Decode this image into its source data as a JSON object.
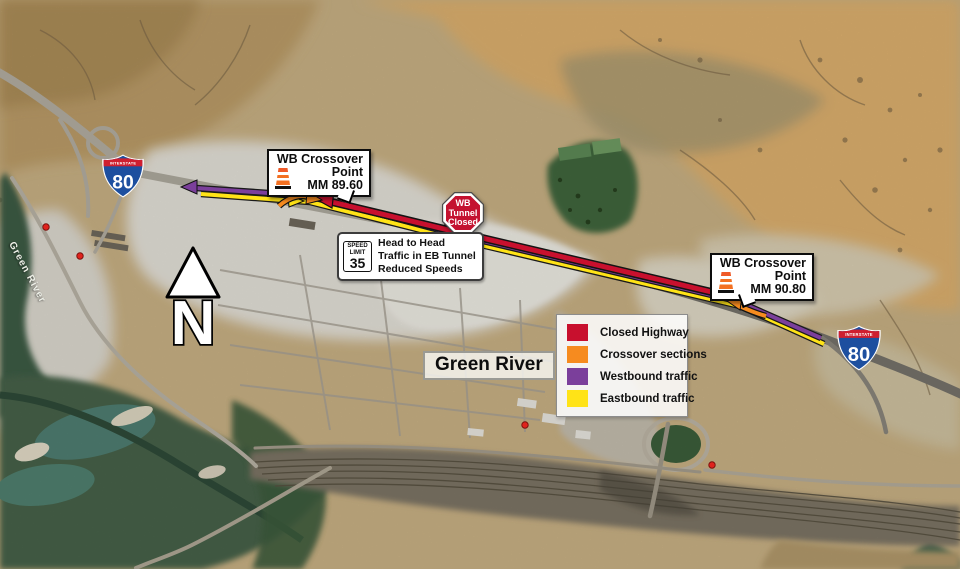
{
  "shield": {
    "top": "INTERSTATE",
    "route": "80"
  },
  "callouts": {
    "west": {
      "title_line1": "WB Crossover",
      "title_line2": "Point",
      "milemarker": "MM 89.60"
    },
    "east": {
      "title_line1": "WB Crossover",
      "title_line2": "Point",
      "milemarker": "MM 90.80"
    }
  },
  "tunnel_sign": {
    "line1": "WB",
    "line2": "Tunnel",
    "line3": "Closed"
  },
  "speed_note": {
    "sign_top": "SPEED",
    "sign_mid": "LIMIT",
    "sign_value": "35",
    "line1": "Head to Head",
    "line2": "Traffic in EB Tunnel",
    "line3": "Reduced Speeds"
  },
  "legend": {
    "items": [
      {
        "label": "Closed Highway",
        "color": "#C8102E"
      },
      {
        "label": "Crossover sections",
        "color": "#F68B1F"
      },
      {
        "label": "Westbound traffic",
        "color": "#7B3F9B"
      },
      {
        "label": "Eastbound traffic",
        "color": "#FFE317"
      }
    ]
  },
  "labels": {
    "city": "Green River",
    "river": "Green River",
    "north": "N"
  }
}
